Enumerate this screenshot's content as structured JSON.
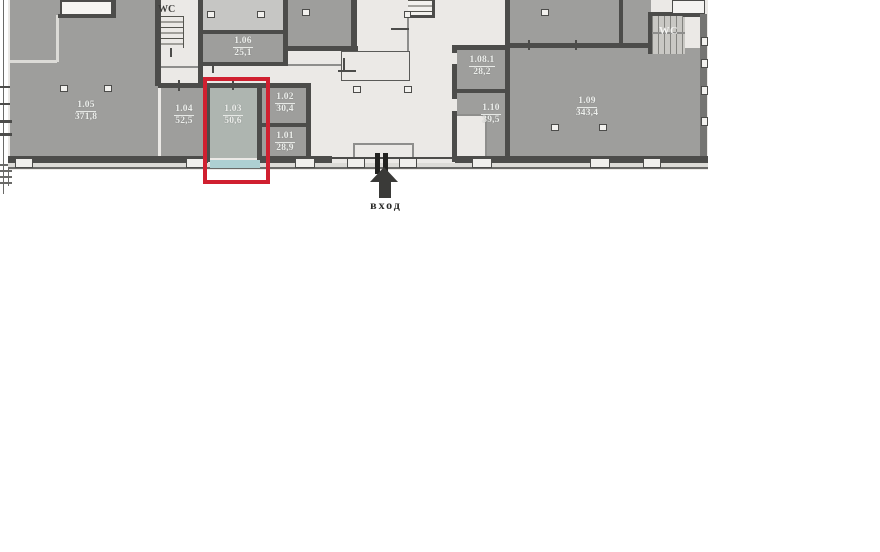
{
  "plan": {
    "type": "floor-plan",
    "entrance_label": "вход",
    "wc_left_label": "WC",
    "wc_right_label": "WC",
    "highlighted_room": "1.03",
    "rooms": {
      "r105": {
        "number": "1.05",
        "area": "371,8"
      },
      "r106": {
        "number": "1.06",
        "area": "25,1"
      },
      "r104": {
        "number": "1.04",
        "area": "52,5"
      },
      "r103": {
        "number": "1.03",
        "area": "50,6"
      },
      "r102": {
        "number": "1.02",
        "area": "30,4"
      },
      "r101": {
        "number": "1.01",
        "area": "28,9"
      },
      "r1081": {
        "number": "1.08.1",
        "area": "28,2"
      },
      "r110": {
        "number": "1.10",
        "area": "39,5"
      },
      "r109": {
        "number": "1.09",
        "area": "343,4"
      }
    },
    "colors": {
      "room_fill": "#9e9e9c",
      "highlighted_room_fill": "#aeb5b0",
      "corridor_fill": "#ebe9e6",
      "wall": "#4c4c4a",
      "window_highlight": "#aed0d2",
      "highlight_border": "#d02030"
    }
  }
}
